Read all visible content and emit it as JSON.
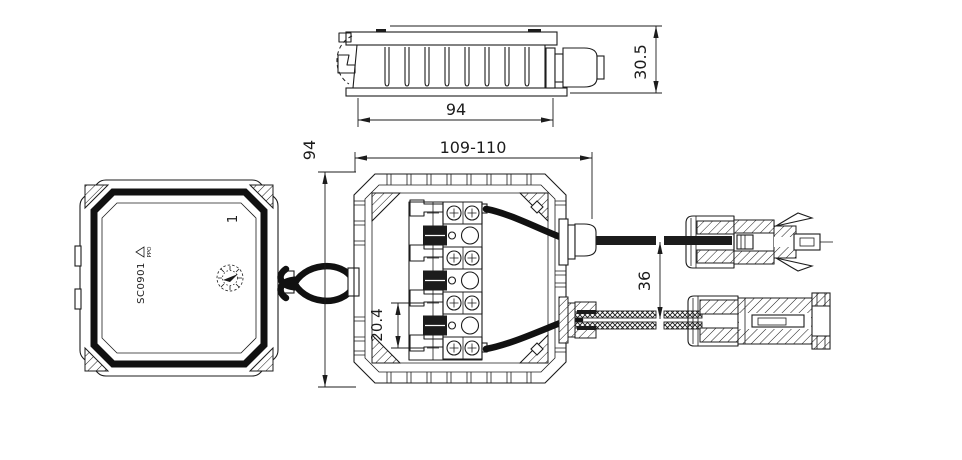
{
  "drawing": {
    "background": "#ffffff",
    "line_color": "#1c1c1c",
    "dimensions": {
      "side_width": "94",
      "side_height": "30.5",
      "front_width": "109-110",
      "front_height": "94",
      "terminal_pitch": "20.4",
      "cable_spacing": "36"
    },
    "lid_markings": {
      "part_number": "SC0901",
      "material": "PPO",
      "cavity_number": "1"
    }
  }
}
